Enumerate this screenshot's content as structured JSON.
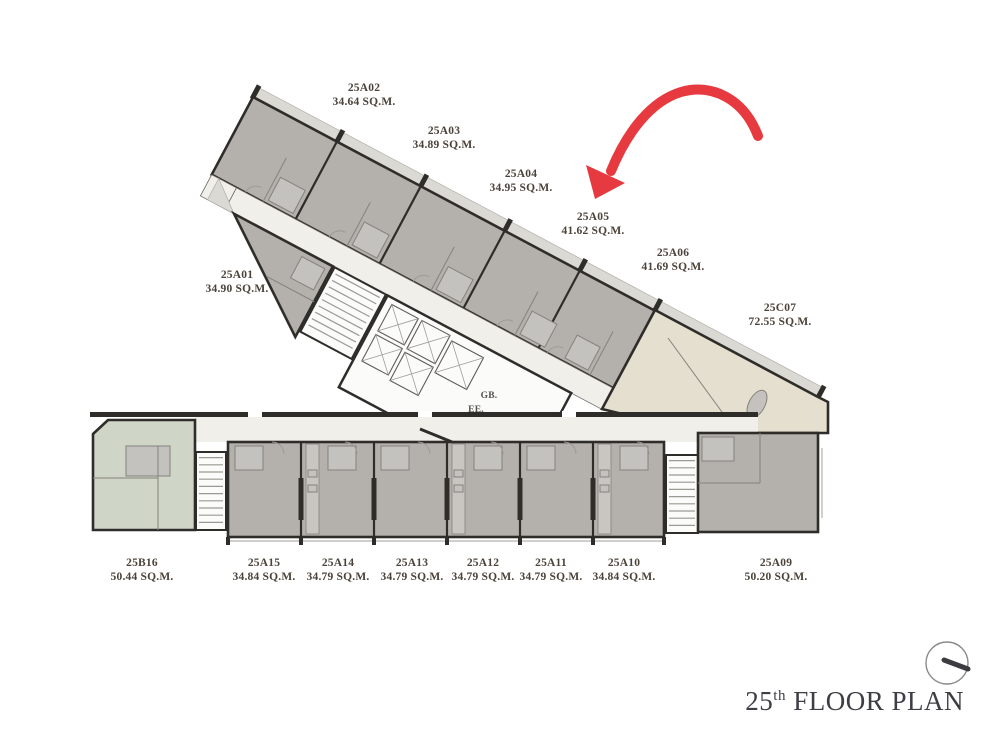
{
  "floor_plan": {
    "title": {
      "number": "25",
      "ordinal": "th",
      "text": " FLOOR PLAN"
    },
    "core_labels": {
      "gb": "GB.",
      "ee": "EE."
    },
    "arrow_target_unit": "25A05",
    "unit_labels": [
      {
        "id": "25A02",
        "area": "34.64 SQ.M.",
        "x": 364,
        "y": 82
      },
      {
        "id": "25A03",
        "area": "34.89 SQ.M.",
        "x": 444,
        "y": 125
      },
      {
        "id": "25A04",
        "area": "34.95 SQ.M.",
        "x": 521,
        "y": 168
      },
      {
        "id": "25A05",
        "area": "41.62 SQ.M.",
        "x": 593,
        "y": 211
      },
      {
        "id": "25A06",
        "area": "41.69 SQ.M.",
        "x": 673,
        "y": 247
      },
      {
        "id": "25C07",
        "area": "72.55 SQ.M.",
        "x": 780,
        "y": 302
      },
      {
        "id": "25A01",
        "area": "34.90 SQ.M.",
        "x": 237,
        "y": 269
      },
      {
        "id": "25B16",
        "area": "50.44 SQ.M.",
        "x": 142,
        "y": 557
      },
      {
        "id": "25A15",
        "area": "34.84 SQ.M.",
        "x": 264,
        "y": 557
      },
      {
        "id": "25A14",
        "area": "34.79 SQ.M.",
        "x": 338,
        "y": 557
      },
      {
        "id": "25A13",
        "area": "34.79 SQ.M.",
        "x": 412,
        "y": 557
      },
      {
        "id": "25A12",
        "area": "34.79 SQ.M.",
        "x": 483,
        "y": 557
      },
      {
        "id": "25A11",
        "area": "34.79 SQ.M.",
        "x": 551,
        "y": 557
      },
      {
        "id": "25A10",
        "area": "34.84 SQ.M.",
        "x": 624,
        "y": 557
      },
      {
        "id": "25A09",
        "area": "50.20 SQ.M.",
        "x": 776,
        "y": 557
      }
    ]
  },
  "colors": {
    "wall": "#2f2d2a",
    "unit": "#b4b1ad",
    "corridor": "#f1efea",
    "beige": "#e5dfd0",
    "green": "#cfd5c7",
    "whiteroom": "#fbfbf9",
    "shaft": "#c8c6c1",
    "bathfill": "#c4c2be",
    "balcony": "#dbd9d4",
    "thin": "#85827d",
    "arc": "#9b9893",
    "tread": "#8a8782",
    "red": "#e73a40",
    "label": "#4b433a",
    "title": "#3e3e44"
  }
}
